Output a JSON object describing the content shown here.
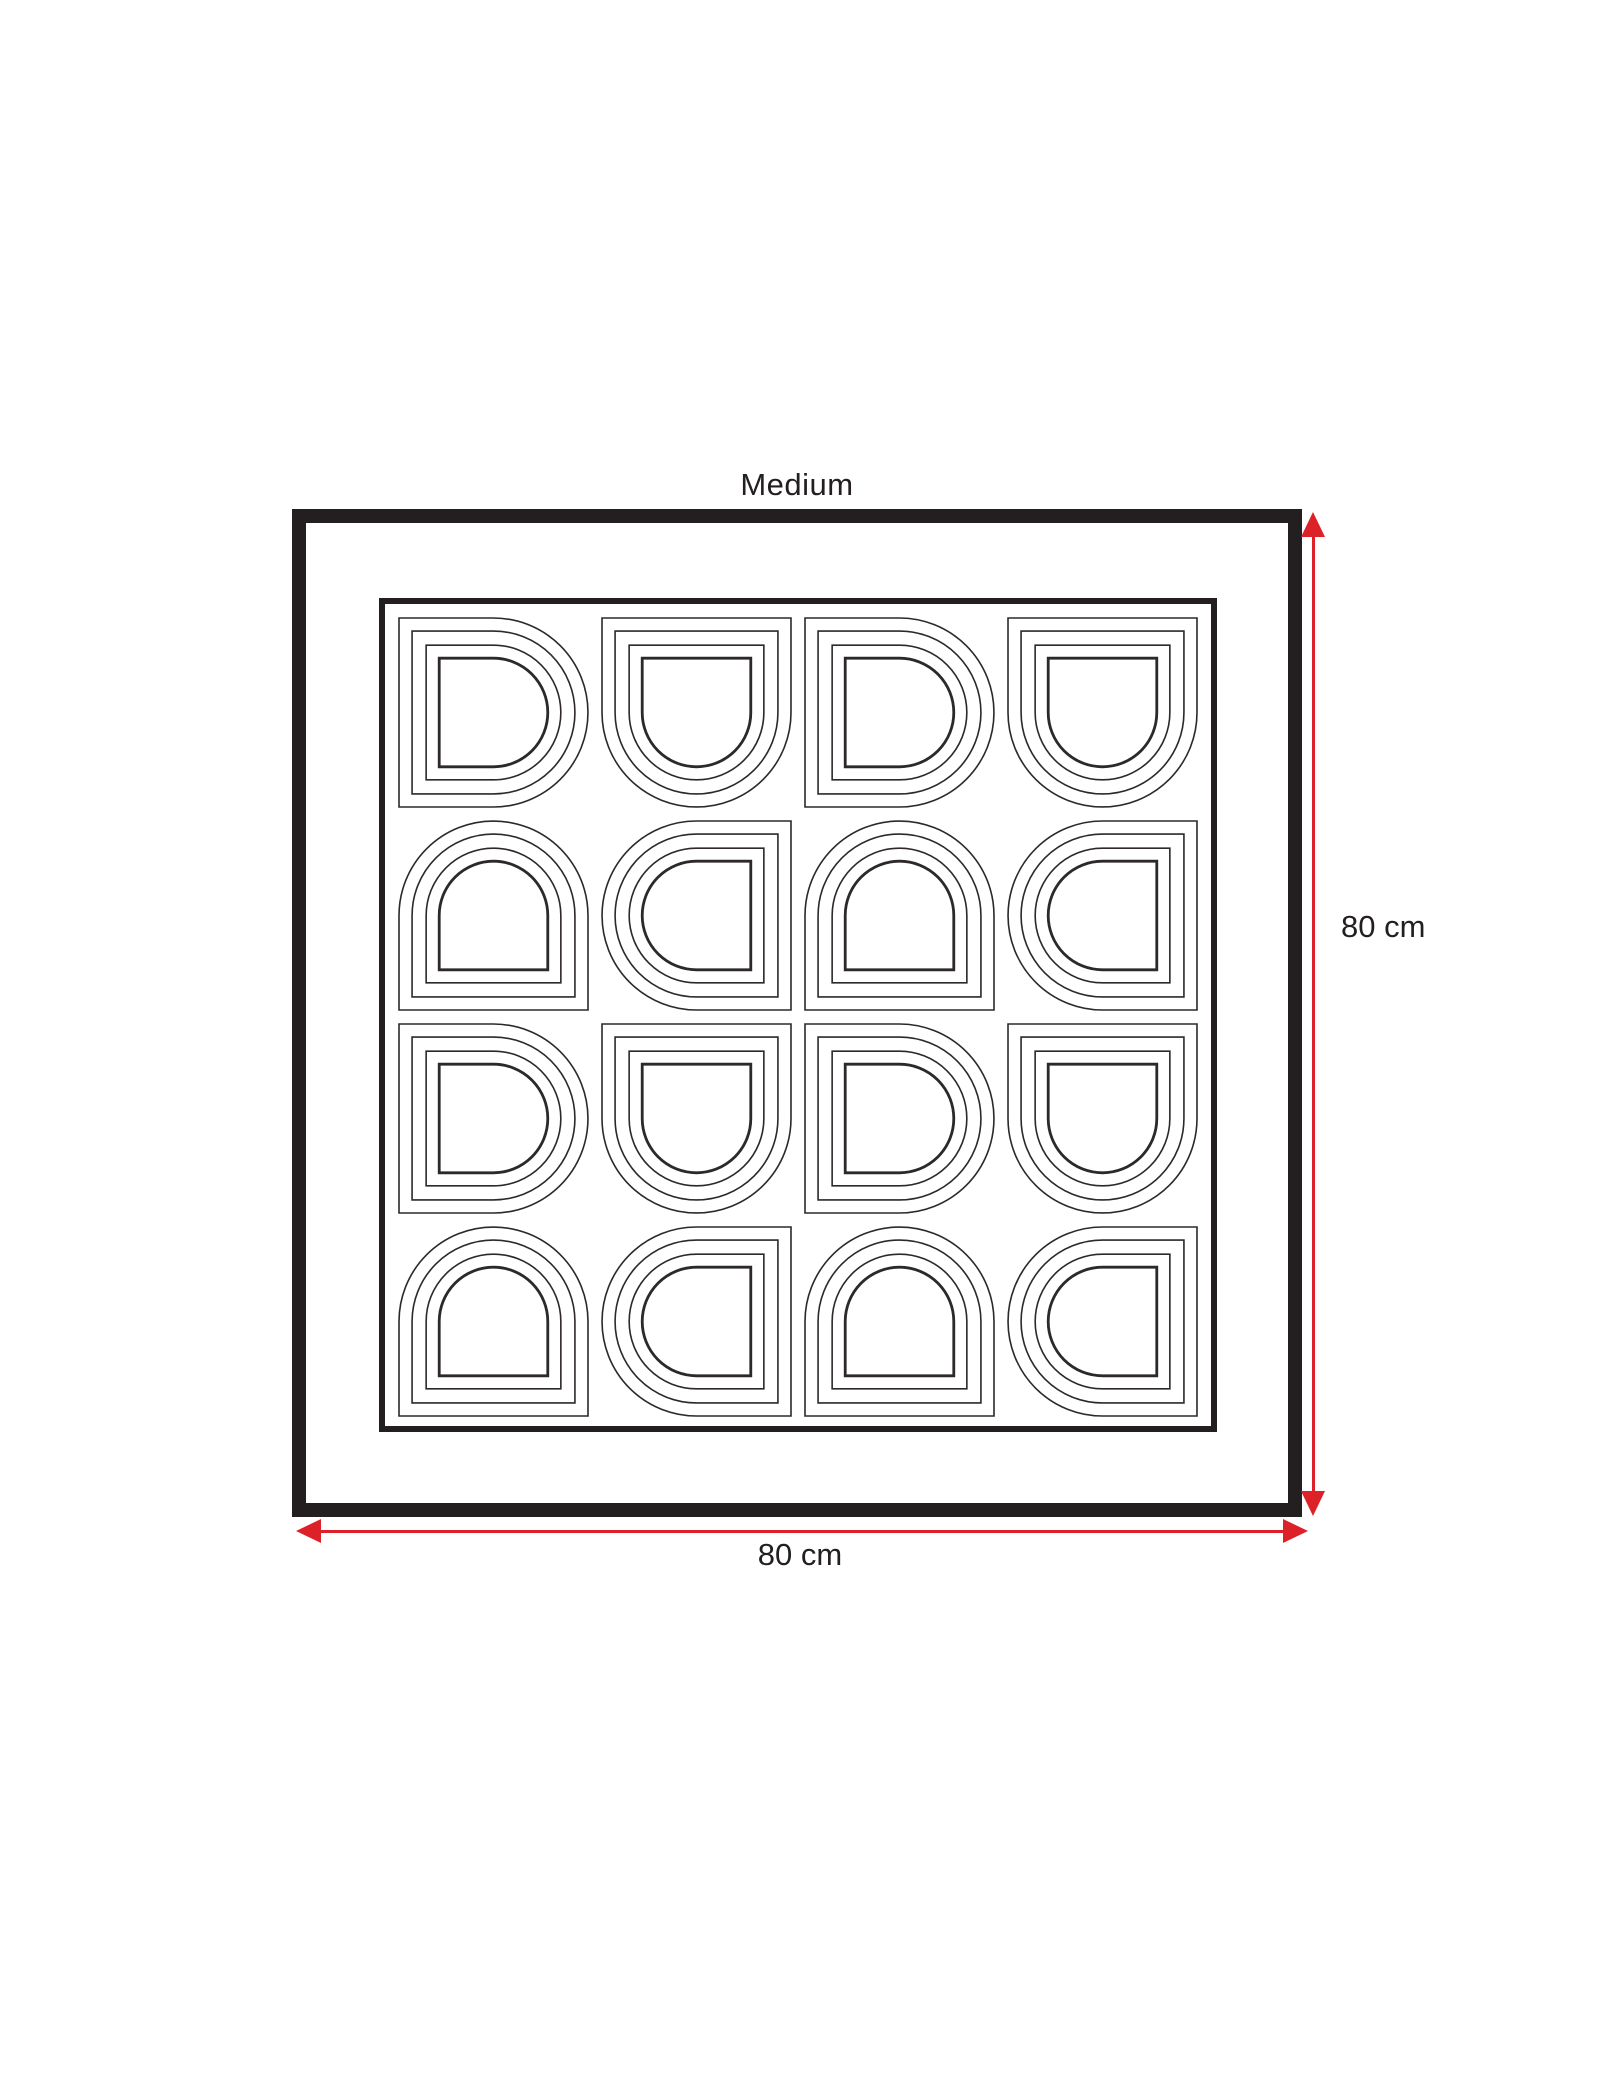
{
  "title": "Medium",
  "dimensions": {
    "height": {
      "label": "80 cm"
    },
    "width": {
      "label": "80 cm"
    }
  },
  "artwork": {
    "rows": 4,
    "cols": 4,
    "motif": "nested-d-arch",
    "contours_per_cell": 4,
    "orientations": [
      [
        "right",
        "down",
        "right",
        "down"
      ],
      [
        "up",
        "left",
        "up",
        "left"
      ],
      [
        "right",
        "down",
        "right",
        "down"
      ],
      [
        "up",
        "left",
        "up",
        "left"
      ]
    ]
  },
  "colors": {
    "frame": "#231f20",
    "pattern_line": "#2d292a",
    "dimension_arrow": "#dd2128",
    "text": "#231f20",
    "background": "#ffffff"
  }
}
